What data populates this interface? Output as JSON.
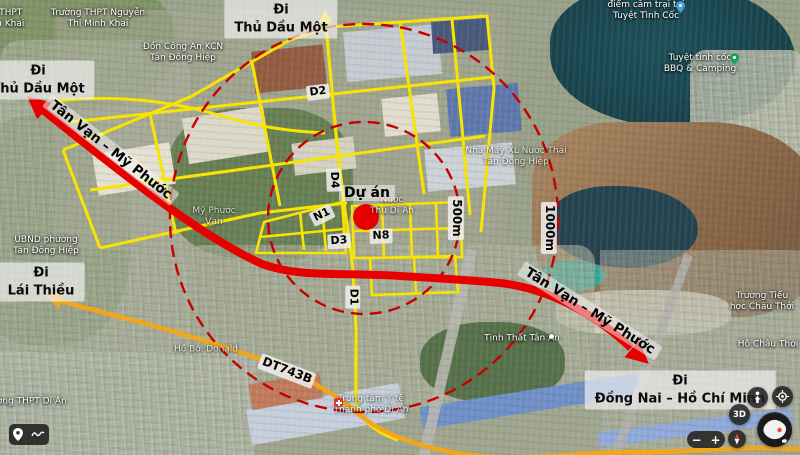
{
  "project": {
    "label": "Dự án"
  },
  "radius": {
    "inner": "500m",
    "outer": "1000m"
  },
  "directions": {
    "top": {
      "line1": "Đi",
      "line2": "Thủ Dầu Một"
    },
    "left": {
      "line1": "Đi",
      "line2": "Thủ Dầu Một"
    },
    "lai_thieu": {
      "line1": "Đi",
      "line2": "Lái Thiều"
    },
    "dong_nai": {
      "line1": "Đi",
      "line2": "Đồng Nai – Hồ Chí Minh"
    }
  },
  "roads": {
    "d1": "D1",
    "d2": "D2",
    "d3": "D3",
    "d4": "D4",
    "n1": "N1",
    "n8": "N8",
    "dt743b": "DT743B",
    "corridor": "Tân Vạn – Mỹ Phước"
  },
  "places": [
    {
      "line1": "Trường THPT Nguyễn",
      "line2": "Thị Minh Khai"
    },
    {
      "line1": "Trường THPT",
      "line2": "Thị Minh Khai"
    },
    {
      "line1": "Đồn Công An KCN",
      "line2": "Tân Đông Hiệp"
    },
    {
      "line1": "điểm cắm trại tại",
      "line2": "Tuyệt Tình Cốc"
    },
    {
      "line1": "Tuyệt tình cốc",
      "line2": "BBQ & Camping"
    },
    {
      "line1": "Nhà Máy XL Nước Thải",
      "line2": "Tân Đông Hiệp"
    },
    {
      "line1": "UBND phường",
      "line2": "Tân Đông Hiệp"
    },
    {
      "line1": "Mỹ Phước",
      "line2": "Vạn"
    },
    {
      "line1": "Nước",
      "line2": "Thủ Dĩ An"
    },
    {
      "line1": "Tịnh Thất Tân An",
      "line2": ""
    },
    {
      "line1": "Trường Tiểu",
      "line2": "học Châu Thới"
    },
    {
      "line1": "Hồ Châu Thới",
      "line2": ""
    },
    {
      "line1": "Hồ Bơi Donald",
      "line2": ""
    },
    {
      "line1": "Trường THPT Dĩ An",
      "line2": ""
    },
    {
      "line1": "Trung tâm Y tế",
      "line2": "Thành phố Dĩ An"
    }
  ],
  "controls": {
    "zoom_in": "+",
    "zoom_out": "−",
    "view_3d": "3D"
  },
  "colors": {
    "road_grid_yellow": "#f7e400",
    "road_provincial_orange": "#f2a71b",
    "corridor_red": "#e60000",
    "radius_circle_red": "#c40000",
    "project_marker_red": "#e60000"
  }
}
